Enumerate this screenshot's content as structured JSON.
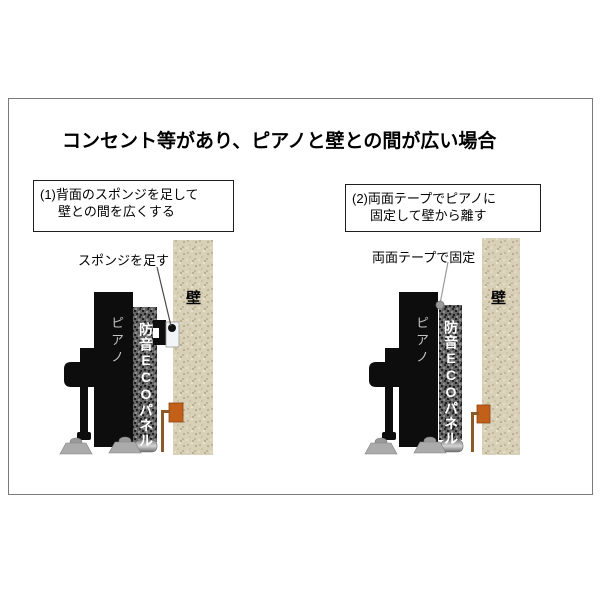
{
  "title": "コンセント等があり、ピアノと壁との間が広い場合",
  "panels": {
    "left": {
      "step_line1": "(1)背面のスポンジを足して",
      "step_line2": "壁との間を広くする",
      "callout": "スポンジを足す",
      "wall_label": "壁",
      "piano_label": "ピアノ",
      "panel_label": "防音ECOパネル"
    },
    "right": {
      "step_line1": "(2)両面テープでピアノに",
      "step_line2": "固定して壁から離す",
      "callout": "両面テープで固定",
      "wall_label": "壁",
      "piano_label": "ピアノ",
      "panel_label": "防音ECOパネル"
    }
  },
  "colors": {
    "frame_border": "#7a7a7a",
    "wall_beige": "#d9d0b8",
    "panel_gray": "#616161",
    "piano_black": "#0d0d0d",
    "outlet_orange": "#c2601a",
    "cord_brown": "#8a5a28",
    "sponge_white": "#f2f4f6",
    "caster_gray": "#ababab"
  }
}
